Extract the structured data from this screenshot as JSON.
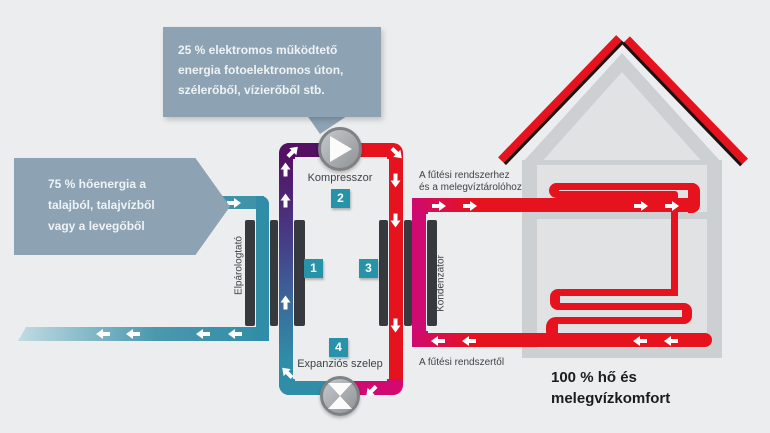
{
  "callouts": {
    "electric_energy": {
      "lines": [
        "25 % elektromos működtető",
        "energia fotoelektromos úton,",
        "szélerőből, vízierőből stb."
      ]
    },
    "heat_source": {
      "lines": [
        "75 % hőenergia a",
        "talajból, talajvízből",
        "vagy a levegőből"
      ]
    }
  },
  "stations": {
    "evaporator": {
      "number": "1",
      "label": "Elpárologtató"
    },
    "compressor": {
      "number": "2",
      "label": "Kompresszor"
    },
    "condenser": {
      "number": "3",
      "label": "Kondenzátor"
    },
    "expansion_valve": {
      "number": "4",
      "label": "Expanziós szelep"
    }
  },
  "labels": {
    "to_heating_line1": "A fűtési rendszerhez",
    "to_heating_line2": "és a melegvíztárolóhoz",
    "from_heating": "A fűtési rendszertől",
    "result_line1": "100 % hő és",
    "result_line2": "melegvízkomfort"
  },
  "colors": {
    "callout": "#8da2b2",
    "teal_pipe": "#2f8da7",
    "purple_pipe": "#541062",
    "red_pipe": "#e6131f",
    "magenta_pipe": "#cf0a70",
    "heat_exchanger_bar": "#36393e",
    "number_badge": "#2793a9",
    "background": "#ecedee"
  }
}
